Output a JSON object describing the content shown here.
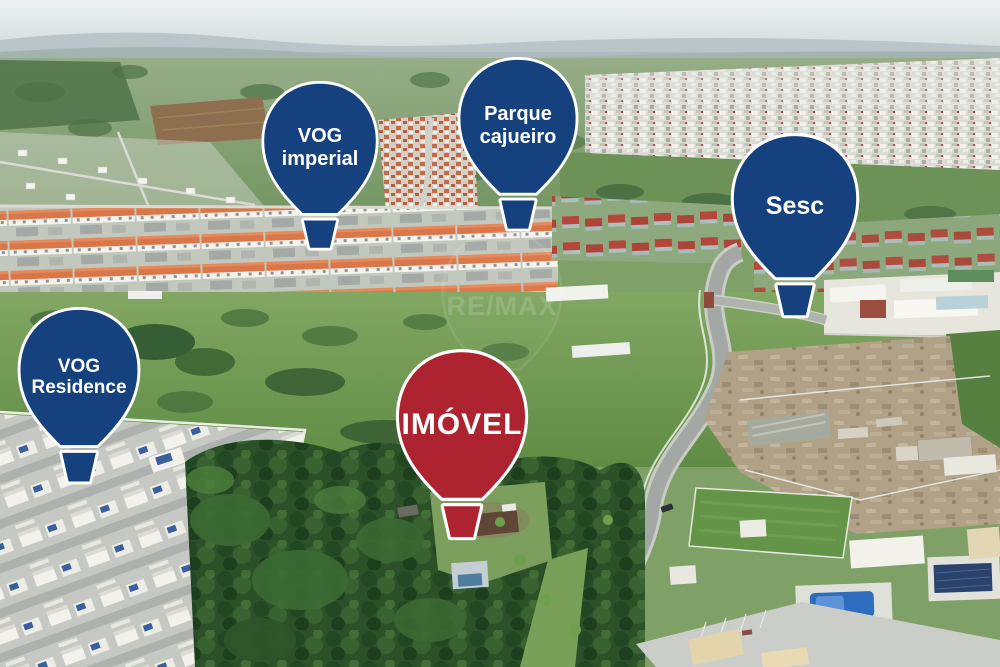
{
  "markers": [
    {
      "id": "vog-imperial",
      "line1": "VOG",
      "line2": "imperial"
    },
    {
      "id": "parque-cajueiro",
      "line1": "Parque",
      "line2": "cajueiro"
    },
    {
      "id": "sesc",
      "line1": "Sesc",
      "line2": ""
    },
    {
      "id": "vog-residence",
      "line1": "VOG",
      "line2": "Residence"
    },
    {
      "id": "imovel",
      "line1": "IMÓVEL",
      "line2": ""
    }
  ],
  "watermark": {
    "text": "RE/MAX"
  },
  "colors": {
    "balloon_blue": "#16417f",
    "balloon_red": "#ae2330",
    "balloon_outline": "#ffffff",
    "label_text": "#ffffff"
  }
}
